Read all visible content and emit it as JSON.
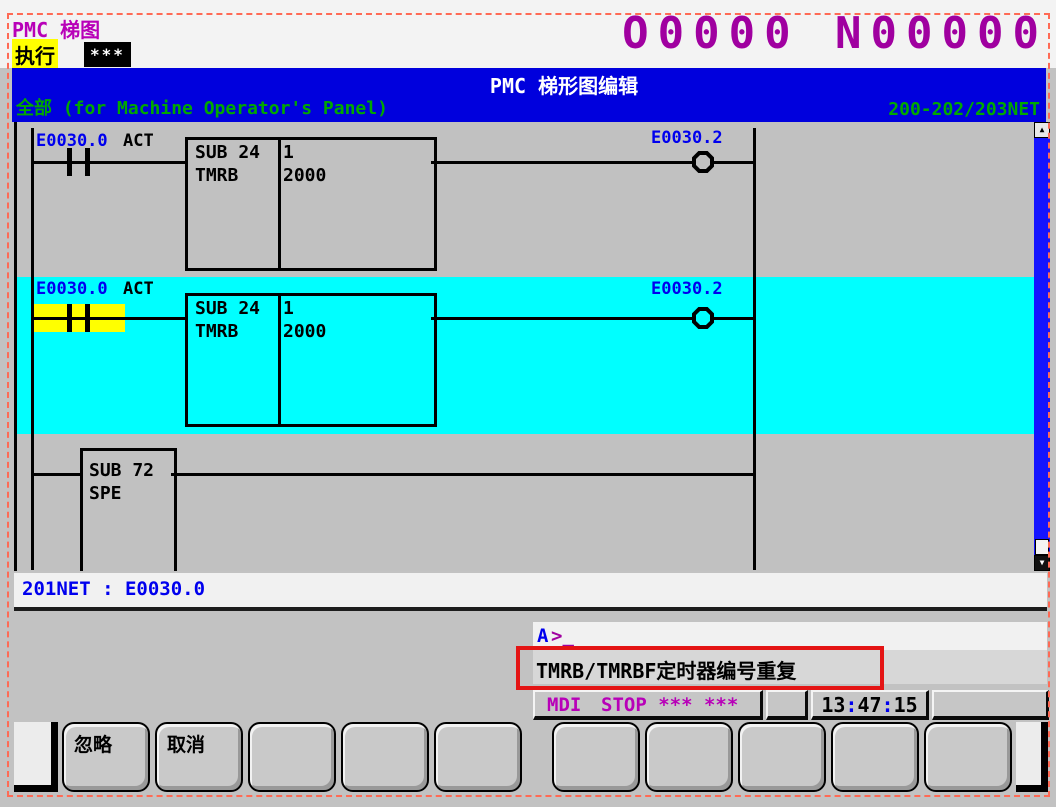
{
  "colors": {
    "accent_magenta": "#b800b8",
    "title_bar_blue": "#0000dd",
    "subtitle_green": "#00a800",
    "selection_cyan": "#00ffff",
    "cursor_yellow": "#ffff00",
    "address_blue": "#0000ee",
    "annotation_red": "#e41414"
  },
  "icons": {
    "scroll_up": "▲",
    "scroll_down": "▼"
  },
  "header": {
    "app_title": "PMC 梯图",
    "mode_label": "执行",
    "mode_stars": "***",
    "program_number": "O0000 N00000"
  },
  "title_bar": {
    "title": "PMC 梯形图编辑",
    "subtitle": "全部 (for Machine Operator's Panel)",
    "net_range": "200-202/203NET"
  },
  "ladder": {
    "rung1": {
      "contact_label": "E0030.0",
      "contact_type": "ACT",
      "sub": "SUB 24",
      "mnemonic": "TMRB",
      "param1": "1",
      "param2": "2000",
      "coil_label": "E0030.2"
    },
    "rung2": {
      "contact_label": "E0030.0",
      "contact_type": "ACT",
      "sub": "SUB 24",
      "mnemonic": "TMRB",
      "param1": "1",
      "param2": "2000",
      "coil_label": "E0030.2"
    },
    "rung3": {
      "sub": "SUB 72",
      "mnemonic": "SPE"
    }
  },
  "net_status": {
    "text": "201NET : E0030.0"
  },
  "prompt": {
    "channel": "A",
    "cursor": ">_"
  },
  "alert": {
    "message": "TMRB/TMRBF定时器编号重复"
  },
  "status_bar": {
    "mode": "MDI",
    "state": "STOP *** ***",
    "colon": ":",
    "time_h": "13",
    "time_m": "47",
    "time_s": "15"
  },
  "softkeys": {
    "row": [
      "忽略",
      "取消",
      "",
      "",
      "",
      "",
      "",
      "",
      "",
      ""
    ]
  }
}
